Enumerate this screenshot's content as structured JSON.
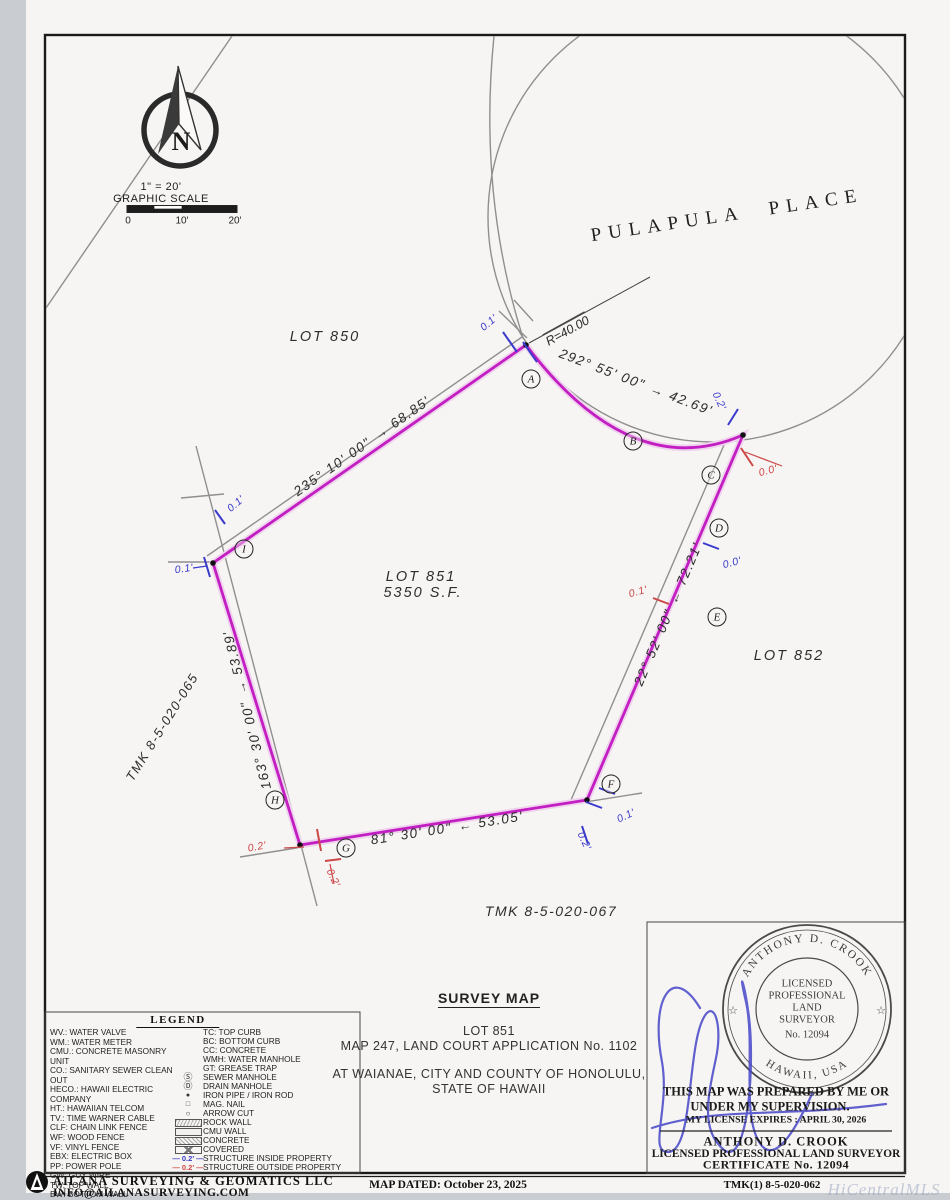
{
  "palette": {
    "boundary": "#c21ec2",
    "structure_inside": "#3a3acc",
    "structure_outside": "#cc4747"
  },
  "compass": {
    "letter": "N"
  },
  "scale_bar": {
    "ratio": "1\" = 20'",
    "title": "GRAPHIC SCALE",
    "ticks": [
      "0",
      "10'",
      "20'"
    ]
  },
  "map": {
    "street": "PULAPULA PLACE",
    "lots": {
      "lot850": "LOT 850",
      "lot851": "LOT 851",
      "lot851_area": "5350 S.F.",
      "lot852": "LOT 852"
    },
    "tmk_west": "TMK 8-5-020-065",
    "tmk_south": "TMK 8-5-020-067",
    "radius_label": "R=40.00",
    "dims": {
      "nw": {
        "bearing": "235° 10' 00\"",
        "dir": "→",
        "distance": "68.85'"
      },
      "curve": {
        "bearing": "292° 55' 00\"",
        "dir": "→",
        "distance": "42.69'"
      },
      "east": {
        "bearing": "22° 52' 00\"",
        "dir": "←",
        "distance": "72.21'"
      },
      "south": {
        "bearing": "81° 30' 00\"",
        "dir": "←",
        "distance": "53.05'"
      },
      "west": {
        "bearing": "163° 30' 00\"",
        "dir": "→",
        "distance": "53.89'"
      }
    },
    "vertices": [
      {
        "letter": "A"
      },
      {
        "letter": "B"
      },
      {
        "letter": "C"
      },
      {
        "letter": "D"
      },
      {
        "letter": "E"
      },
      {
        "letter": "F"
      },
      {
        "letter": "G"
      },
      {
        "letter": "H"
      },
      {
        "letter": "I"
      }
    ],
    "offsets": [
      {
        "value": "0.1'",
        "type": "inside"
      },
      {
        "value": "0.2'",
        "type": "inside"
      },
      {
        "value": "0.0'",
        "type": "outside"
      },
      {
        "value": "0.0'",
        "type": "inside"
      },
      {
        "value": "0.1'",
        "type": "outside"
      },
      {
        "value": "0.1'",
        "type": "inside"
      },
      {
        "value": "0.2'",
        "type": "inside"
      },
      {
        "value": "0.2'",
        "type": "outside"
      },
      {
        "value": "0.2'",
        "type": "outside"
      },
      {
        "value": "0.1'",
        "type": "inside"
      },
      {
        "value": "0.1'",
        "type": "inside"
      }
    ]
  },
  "legend": {
    "title": "LEGEND",
    "left": [
      "WV.: WATER VALVE",
      "WM.: WATER METER",
      "CMU.: CONCRETE MASONRY UNIT",
      "CO.: SANITARY SEWER CLEAN OUT",
      "HECO.: HAWAII ELECTRIC COMPANY",
      "HT.: HAWAIIAN TELCOM",
      "TV.: TIME WARNER CABLE",
      "CLF: CHAIN LINK FENCE",
      "WF: WOOD FENCE",
      "VF: VINYL FENCE",
      "EBX: ELECTRIC BOX",
      "PP: POWER POLE",
      "GW: GUY WIRE",
      "TW: TOP WALL",
      "BW: BOTTOM WALL"
    ],
    "right": [
      {
        "glyph": "",
        "label": "TC: TOP CURB"
      },
      {
        "glyph": "",
        "label": "BC: BOTTOM CURB"
      },
      {
        "glyph": "",
        "label": "CC: CONCRETE"
      },
      {
        "glyph": "",
        "label": "WMH: WATER MANHOLE"
      },
      {
        "glyph": "",
        "label": "GT: GREASE TRAP"
      },
      {
        "glyph": "Ⓢ",
        "label": "SEWER MANHOLE"
      },
      {
        "glyph": "Ⓓ",
        "label": "DRAIN MANHOLE"
      },
      {
        "glyph": "●",
        "label": "IRON PIPE / IRON ROD"
      },
      {
        "glyph": "□",
        "label": "MAG. NAIL"
      },
      {
        "glyph": "○",
        "label": "ARROW CUT"
      },
      {
        "glyph": "",
        "label": "ROCK WALL"
      },
      {
        "glyph": "",
        "label": "CMU WALL"
      },
      {
        "glyph": "",
        "label": "CONCRETE"
      },
      {
        "glyph": "",
        "label": "COVERED"
      },
      {
        "glyph": "",
        "label": "STRUCTURE INSIDE PROPERTY"
      },
      {
        "glyph": "",
        "label": "STRUCTURE OUTSIDE PROPERTY"
      }
    ],
    "dim_value": "0.2'",
    "dash": "—"
  },
  "title_block": {
    "title": "SURVEY MAP",
    "line1": "LOT 851",
    "line2": "MAP 247, LAND COURT APPLICATION No. 1102",
    "line3": "AT WAIANAE, CITY AND COUNTY OF HONOLULU,",
    "line4": "STATE OF HAWAII"
  },
  "stamp": {
    "seal_name": "ANTHONY D. CROOK",
    "seal_region": "HAWAII, USA",
    "star": "☆",
    "seal_lines": [
      "LICENSED",
      "PROFESSIONAL",
      "LAND",
      "SURVEYOR",
      "No. 12094"
    ],
    "statement1": "THIS MAP WAS PREPARED BY ME OR",
    "statement2": "UNDER MY SUPERVISION.",
    "expires": "MY LICENSE EXPIRES : APRIL 30, 2026",
    "name": "ANTHONY D. CROOK",
    "title": "LICENSED PROFESSIONAL LAND SURVEYOR",
    "certificate": "CERTIFICATE No. 12094"
  },
  "footer": {
    "company": "AILANA SURVEYING & GEOMATICS LLC",
    "email": "INFO@AILANASURVEYING.COM",
    "map_dated": "MAP DATED: October 23, 2025",
    "tmk": "TMK(1) 8-5-020-062"
  },
  "watermark": "HiCentralMLS"
}
